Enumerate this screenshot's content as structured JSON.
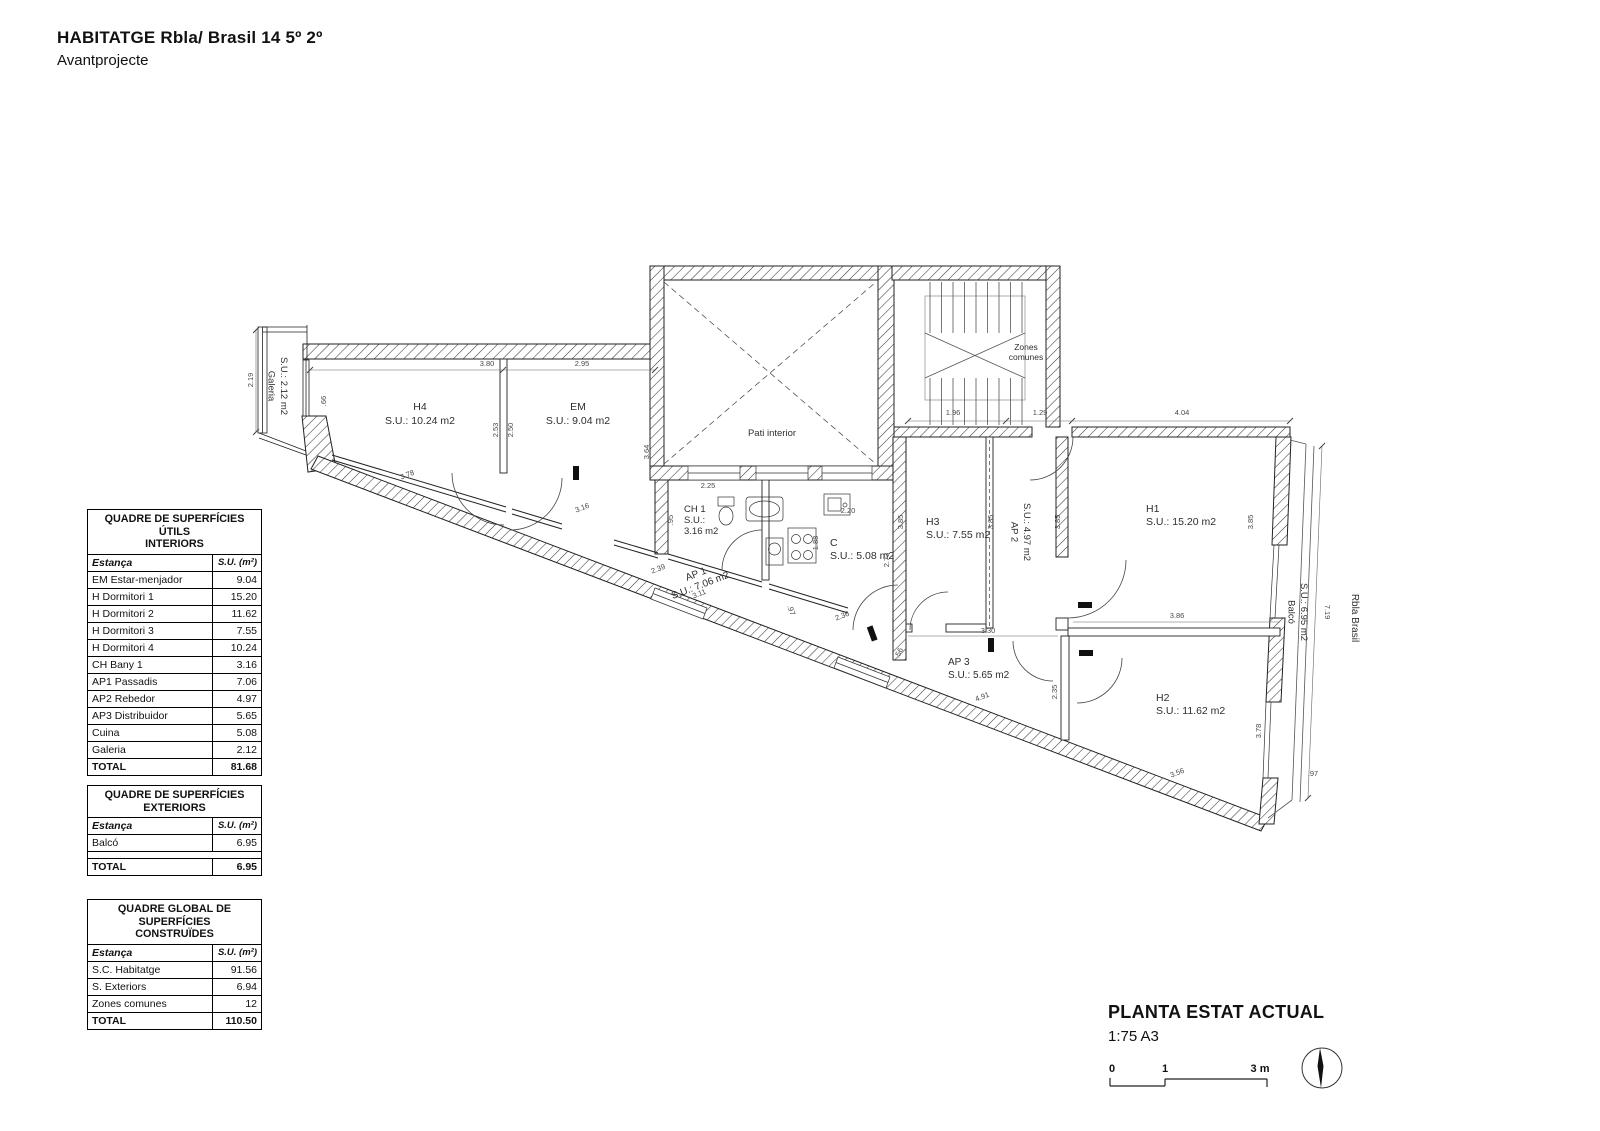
{
  "header": {
    "title": "HABITATGE Rbla/ Brasil 14 5º 2º",
    "subtitle": "Avantprojecte"
  },
  "tables": [
    {
      "id": "interiors",
      "title": [
        "QUADRE DE SUPERFÍCIES ÚTILS",
        "INTERIORS"
      ],
      "col_room": "Estança",
      "col_area": "S.U. (m²)",
      "rows": [
        [
          "EM Estar-menjador",
          "9.04"
        ],
        [
          "H Dormitori 1",
          "15.20"
        ],
        [
          "H Dormitori 2",
          "11.62"
        ],
        [
          "H Dormitori 3",
          "7.55"
        ],
        [
          "H Dormitori 4",
          "10.24"
        ],
        [
          "CH Bany 1",
          "3.16"
        ],
        [
          "AP1 Passadis",
          "7.06"
        ],
        [
          "AP2 Rebedor",
          "4.97"
        ],
        [
          "AP3 Distribuidor",
          "5.65"
        ],
        [
          "Cuina",
          "5.08"
        ],
        [
          "Galeria",
          "2.12"
        ]
      ],
      "total": [
        "TOTAL",
        "81.68"
      ]
    },
    {
      "id": "exteriors",
      "title": [
        "QUADRE DE SUPERFÍCIES",
        "EXTERIORS"
      ],
      "col_room": "Estança",
      "col_area": "S.U. (m²)",
      "rows": [
        [
          "Balcó",
          "6.95"
        ]
      ],
      "gap": true,
      "total": [
        "TOTAL",
        "6.95"
      ]
    },
    {
      "id": "construides",
      "title": [
        "QUADRE GLOBAL DE SUPERFÍCIES",
        "CONSTRUÏDES"
      ],
      "col_room": "Estança",
      "col_area": "S.U. (m²)",
      "rows": [
        [
          "S.C. Habitatge",
          "91.56"
        ],
        [
          "S. Exteriors",
          "6.94"
        ],
        [
          "Zones comunes",
          "12"
        ]
      ],
      "total": [
        "TOTAL",
        "110.50"
      ]
    }
  ],
  "titleblock": {
    "title": "PLANTA ESTAT ACTUAL",
    "scale": "1:75 A3",
    "scalebar": {
      "zero": "0",
      "one": "1",
      "three": "3 m"
    }
  },
  "plan": {
    "labels": [
      {
        "lines": [
          "Galeria",
          "S.U.: 2.12 m2"
        ],
        "x": 281,
        "y": 386,
        "r": 90,
        "s": 9.5
      },
      {
        "lines": [
          "H4",
          "S.U.: 10.24 m2"
        ],
        "x": 420,
        "y": 410,
        "s": 10.5,
        "lh": 14
      },
      {
        "lines": [
          "EM",
          "S.U.: 9.04 m2"
        ],
        "x": 578,
        "y": 410,
        "s": 10.5,
        "lh": 14
      },
      {
        "lines": [
          "Pati interior"
        ],
        "x": 772,
        "y": 436,
        "s": 9.5
      },
      {
        "lines": [
          "Zones",
          "comunes"
        ],
        "x": 1026,
        "y": 350,
        "s": 8.5,
        "lh": 10
      },
      {
        "lines": [
          "CH 1",
          "S.U.:",
          "3.16 m2"
        ],
        "x": 684,
        "y": 512,
        "s": 9.5,
        "a": "start",
        "lh": 11
      },
      {
        "lines": [
          "C",
          "S.U.: 5.08 m2"
        ],
        "x": 830,
        "y": 546,
        "s": 10.5,
        "a": "start",
        "lh": 13
      },
      {
        "lines": [
          "AP 1",
          "S.U.: 7.06 m2"
        ],
        "x": 697,
        "y": 577,
        "r": -21,
        "s": 10,
        "lh": 12
      },
      {
        "lines": [
          "H3",
          "S.U.: 7.55 m2"
        ],
        "x": 926,
        "y": 525,
        "s": 10.5,
        "a": "start",
        "lh": 13
      },
      {
        "lines": [
          "AP 2",
          "S.U.: 4.97 m2"
        ],
        "x": 1024,
        "y": 532,
        "r": 90,
        "s": 9.5
      },
      {
        "lines": [
          "H1",
          "S.U.: 15.20 m2"
        ],
        "x": 1146,
        "y": 512,
        "s": 10.5,
        "a": "start",
        "lh": 13
      },
      {
        "lines": [
          "AP 3",
          "S.U.: 5.65 m2"
        ],
        "x": 948,
        "y": 665,
        "s": 10,
        "a": "start",
        "lh": 13
      },
      {
        "lines": [
          "H2",
          "S.U.: 11.62 m2"
        ],
        "x": 1156,
        "y": 701,
        "s": 10.5,
        "a": "start",
        "lh": 13
      },
      {
        "lines": [
          "Balcó",
          "S.U.: 6.95 m2"
        ],
        "x": 1301,
        "y": 612,
        "r": 90,
        "s": 9.5
      },
      {
        "lines": [
          "Rbla Brasil"
        ],
        "x": 1352,
        "y": 618,
        "r": 90,
        "s": 10
      }
    ],
    "dims": [
      {
        "t": "3.80",
        "x": 487,
        "y": 366
      },
      {
        "t": "2.95",
        "x": 582,
        "y": 366
      },
      {
        "t": "2.19",
        "x": 253,
        "y": 380,
        "r": -90
      },
      {
        "t": ".66",
        "x": 326,
        "y": 401,
        "r": -90
      },
      {
        "t": "2.53",
        "x": 498,
        "y": 430,
        "r": -90
      },
      {
        "t": "2.50",
        "x": 513,
        "y": 430,
        "r": -90
      },
      {
        "t": "3.78",
        "x": 408,
        "y": 477,
        "r": -21
      },
      {
        "t": "3.16",
        "x": 583,
        "y": 510,
        "r": -21
      },
      {
        "t": "3.64",
        "x": 649,
        "y": 452,
        "r": -90
      },
      {
        "t": ".95",
        "x": 673,
        "y": 520,
        "r": -90
      },
      {
        "t": "2.25",
        "x": 708,
        "y": 488
      },
      {
        "t": "2.20",
        "x": 848,
        "y": 513
      },
      {
        "t": "1.88",
        "x": 818,
        "y": 543,
        "r": -90
      },
      {
        "t": "2.73",
        "x": 889,
        "y": 560,
        "r": -90
      },
      {
        "t": "2.39",
        "x": 659,
        "y": 571,
        "r": -21
      },
      {
        "t": "3.11",
        "x": 700,
        "y": 596,
        "r": -21
      },
      {
        "t": ".97",
        "x": 789,
        "y": 611,
        "r": 70
      },
      {
        "t": "2.36",
        "x": 843,
        "y": 618,
        "r": -21
      },
      {
        "t": "1.96",
        "x": 953,
        "y": 415
      },
      {
        "t": "1.29",
        "x": 1040,
        "y": 415
      },
      {
        "t": "4.04",
        "x": 1182,
        "y": 415
      },
      {
        "t": "3.85",
        "x": 903,
        "y": 522,
        "r": -90
      },
      {
        "t": "3.85",
        "x": 993,
        "y": 522,
        "r": -90
      },
      {
        "t": "3.85",
        "x": 1060,
        "y": 522,
        "r": -90
      },
      {
        "t": "3.85",
        "x": 1253,
        "y": 522,
        "r": -90
      },
      {
        "t": "3.30",
        "x": 988,
        "y": 633
      },
      {
        "t": "3.86",
        "x": 1177,
        "y": 618
      },
      {
        "t": "2.35",
        "x": 1057,
        "y": 692,
        "r": -90
      },
      {
        "t": "4.91",
        "x": 983,
        "y": 699,
        "r": -21
      },
      {
        "t": ".56",
        "x": 901,
        "y": 654,
        "r": -65
      },
      {
        "t": "3.78",
        "x": 1261,
        "y": 731,
        "r": -90
      },
      {
        "t": "3.56",
        "x": 1178,
        "y": 775,
        "r": -21
      },
      {
        "t": ".97",
        "x": 1313,
        "y": 776
      },
      {
        "t": "7.19",
        "x": 1325,
        "y": 612,
        "r": 90
      }
    ]
  }
}
